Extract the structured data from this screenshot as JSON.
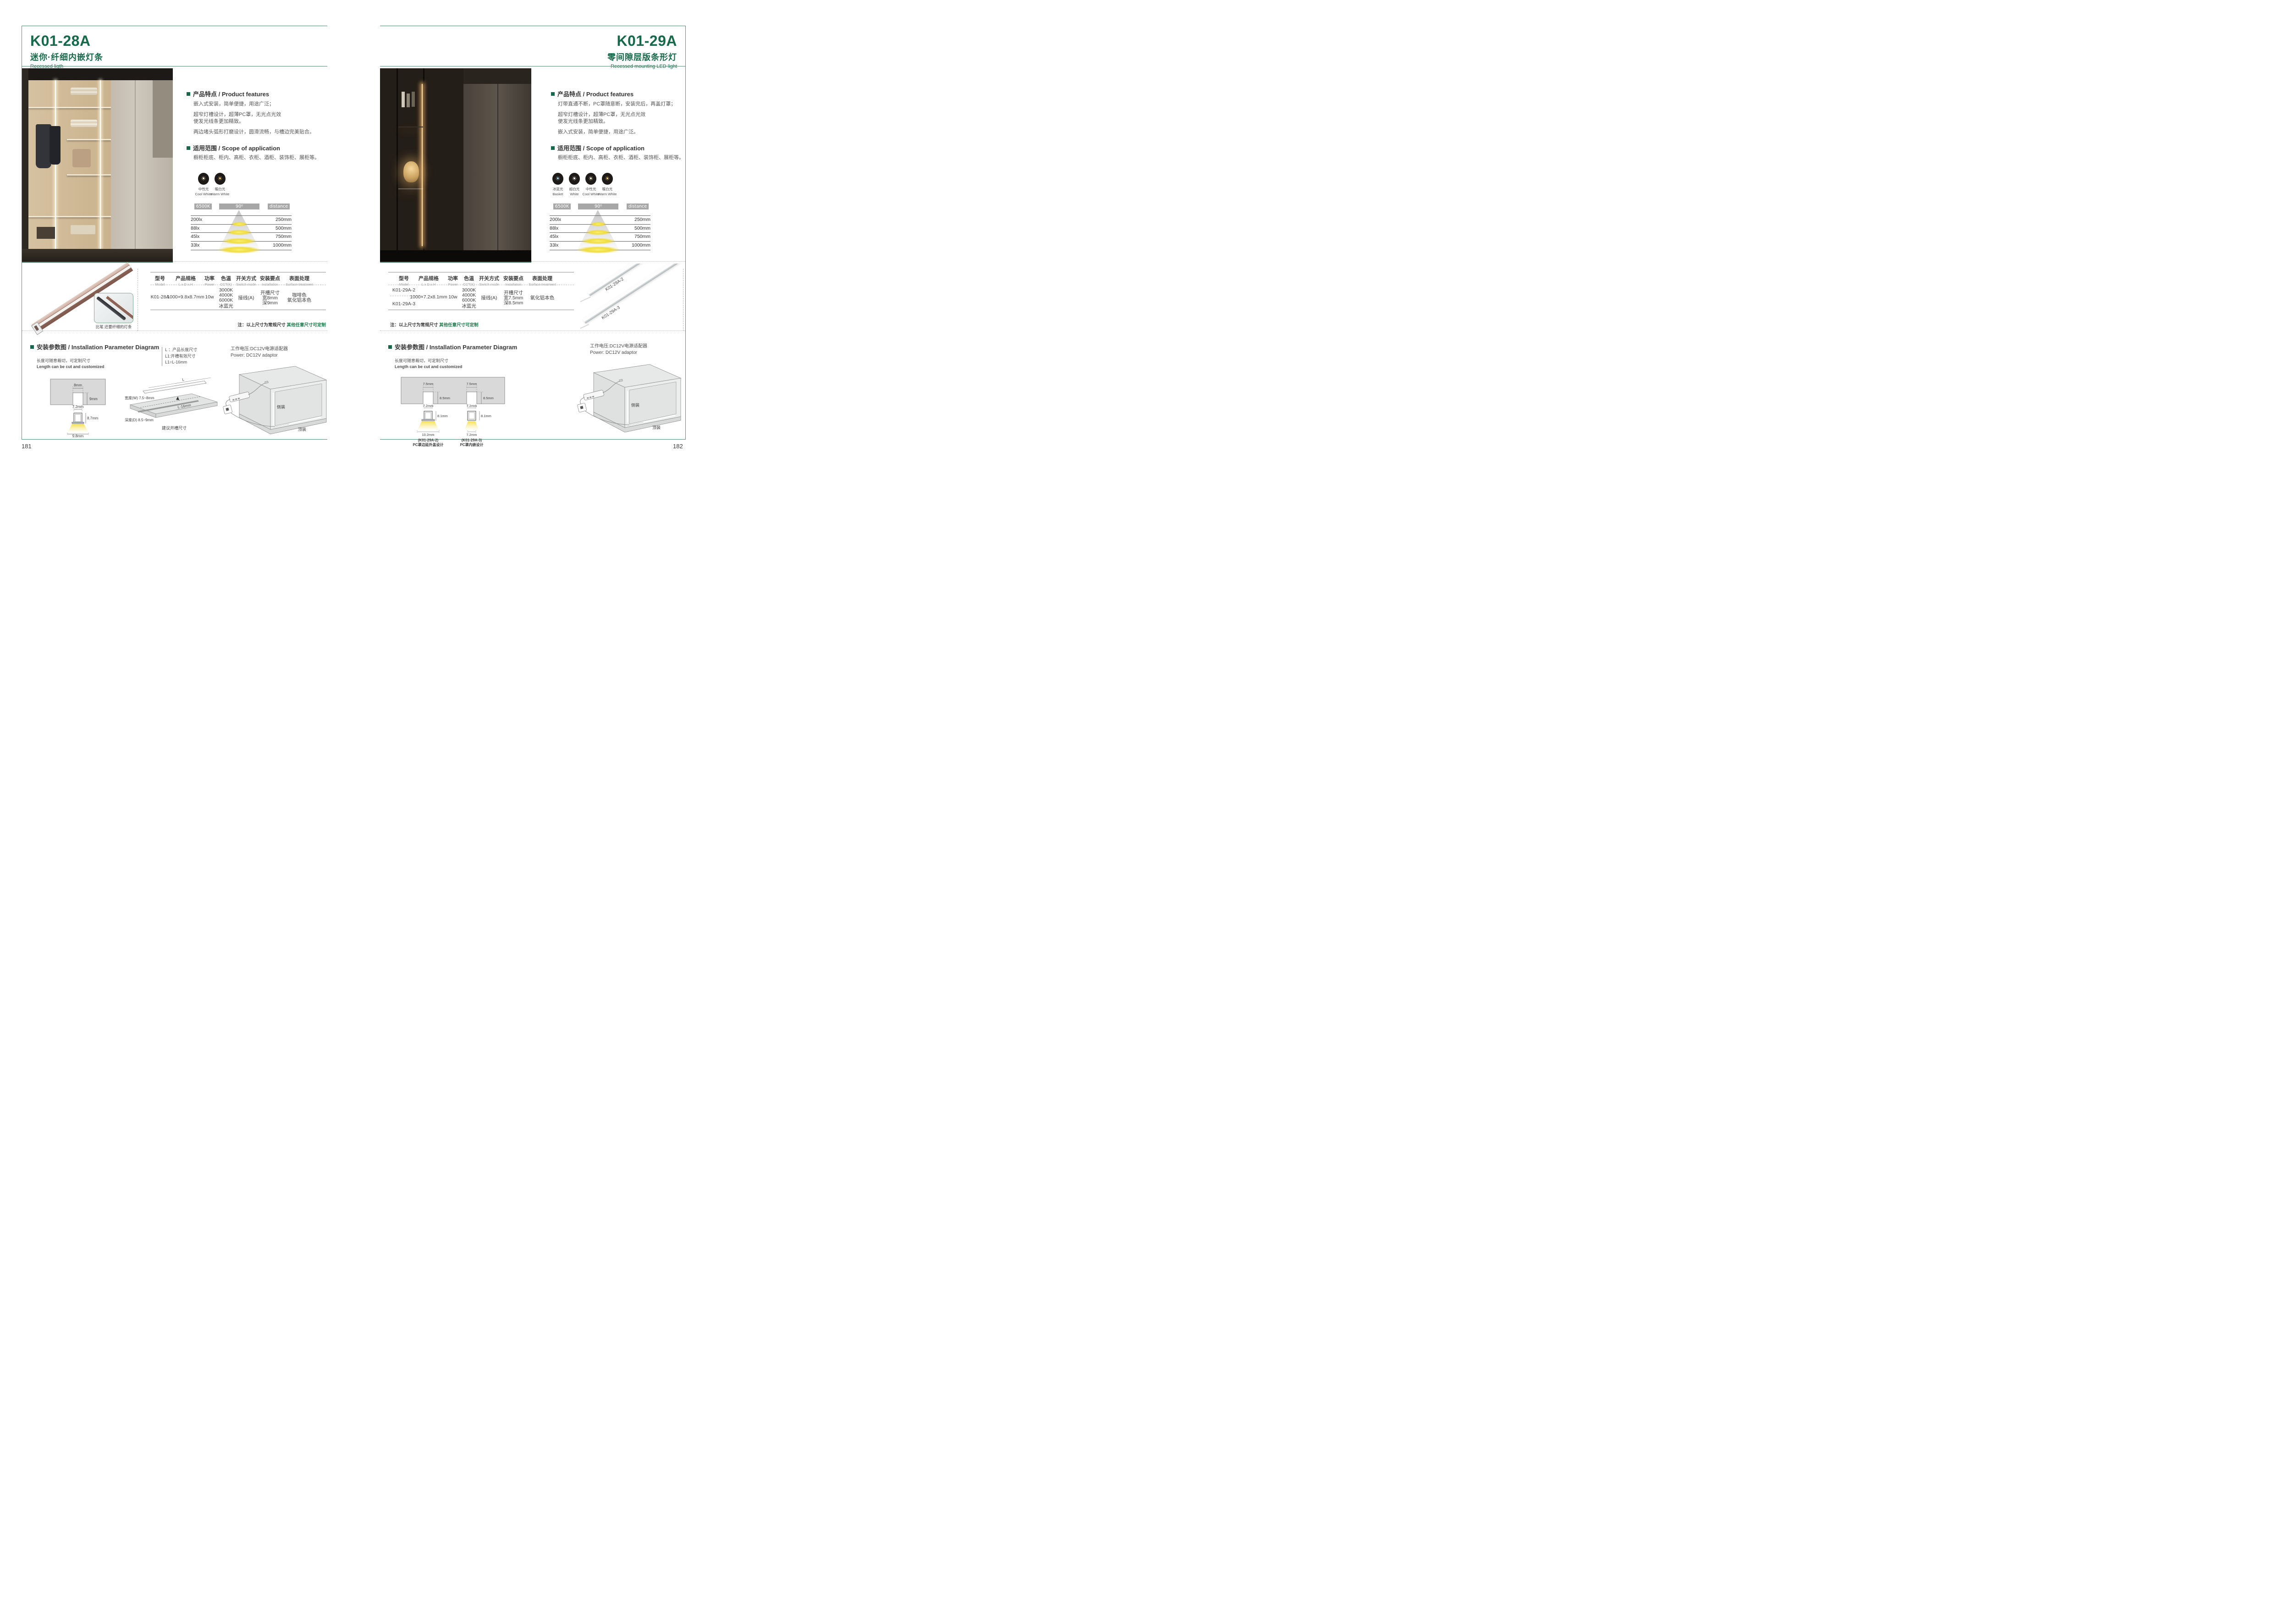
{
  "accent": {
    "green": "#16694a",
    "frame": "#5d8973",
    "note_green": "#1e7a4d"
  },
  "chart_data": [
    {
      "type": "table",
      "cct": "6500K",
      "beam_angle": "90⁰",
      "distance_label": "distance",
      "rows": [
        {
          "lux": "200lx",
          "distance": "250mm"
        },
        {
          "lux": "88lx",
          "distance": "500mm"
        },
        {
          "lux": "45lx",
          "distance": "750mm"
        },
        {
          "lux": "33lx",
          "distance": "1000mm"
        }
      ]
    },
    {
      "type": "table",
      "cct": "6500K",
      "beam_angle": "90⁰",
      "distance_label": "distance",
      "rows": [
        {
          "lux": "200lx",
          "distance": "250mm"
        },
        {
          "lux": "88lx",
          "distance": "500mm"
        },
        {
          "lux": "45lx",
          "distance": "750mm"
        },
        {
          "lux": "33lx",
          "distance": "1000mm"
        }
      ]
    }
  ],
  "pages": [
    {
      "code": "K01-28A",
      "subtitle_cn": "迷你·纤细内嵌灯条",
      "subtitle_en": "Recessed ligth",
      "page_number": "181",
      "features_heading": "产品特点 / Product features",
      "features": [
        "嵌入式安装，简单便捷，用途广泛；",
        "超窄灯槽设计，超薄PC罩，无光点光效",
        "使发光线条更加精致。",
        "两边堵头弧形打磨设计，圆滑流畅，与槽边完美贴合。"
      ],
      "scope_heading": "适用范围 / Scope of application",
      "scope_text": "橱柜柜底、柜内、高柜、衣柜、酒柜、装饰柜、展柜等。",
      "light_icons": [
        {
          "label_cn": "中性光",
          "label_en": "Cool White",
          "color": "#fdf3d8"
        },
        {
          "label_cn": "暖白光",
          "label_en": "Warm White",
          "color": "#f2cc7d"
        }
      ],
      "table": {
        "headers": [
          {
            "cn": "型号",
            "en": "Model"
          },
          {
            "cn": "产品规格",
            "en": "L x D x H"
          },
          {
            "cn": "功率",
            "en": "Power"
          },
          {
            "cn": "色温",
            "en": "CCT(K)"
          },
          {
            "cn": "开关方式",
            "en": "Switch mode"
          },
          {
            "cn": "安装要点",
            "en": "Installation"
          },
          {
            "cn": "表面处理",
            "en": "Surface treatment"
          }
        ],
        "model": "K01-28A",
        "size": "1000×9.8x8.7mm",
        "power": "10w",
        "cct": [
          "3000K",
          "4000K",
          "6000K",
          "冰蓝光"
        ],
        "switch": "接线(A)",
        "install": [
          "开槽尺寸",
          "宽8mm",
          "深9mm"
        ],
        "surface": [
          "咖啡色",
          "氧化铝本色"
        ]
      },
      "note_prefix": "注：以上尺寸为常规尺寸 ",
      "note_green": "其他任意尺寸可定制",
      "photo_caption": "比笔 还要纤细的灯条",
      "install": {
        "heading": "安装参数图 / Installation Parameter Diagram",
        "length_cn": "长度可随意裁切，可定制尺寸",
        "length_en": "Length can be cut and customized",
        "cross": {
          "slot_w": "8mm",
          "slot_d": "9mm",
          "prof_w": "7.2mm",
          "prof_h": "8.7mm",
          "beam_w": "9.8mm"
        },
        "legend": [
          "L ：产品长度尺寸",
          "L1:开槽有效尺寸",
          "L1=L-16mm"
        ],
        "board": {
          "len": "L",
          "len2": "L-16mm",
          "width": "宽度(W) 7.5~8mm",
          "depth": "深度(D) 8.5~9mm",
          "suggest": "建议开槽尺寸"
        },
        "power_cn": "工作电压:DC12V电源适配器",
        "power_en": "Power: DC12V adaptor",
        "mount_side": "侧装",
        "mount_top": "顶装"
      }
    },
    {
      "code": "K01-29A",
      "subtitle_cn": "零间隙层版条形灯",
      "subtitle_en": "Recessed mounting LED light",
      "page_number": "182",
      "features_heading": "产品特点 / Product features",
      "features": [
        "灯带直通不断，PC罩随意断，安装完后，再盖灯罩；",
        "超窄灯槽设计，超薄PC罩，无光点光效",
        "使发光线条更加精致。",
        "嵌入式安装，简单便捷，用途广泛。"
      ],
      "scope_heading": "适用范围 / Scope of application",
      "scope_text": "橱柜柜底、柜内、高柜、衣柜、酒柜、装饰柜、展柜等。",
      "light_icons": [
        {
          "label_cn": "冰蓝光",
          "label_en": "Basket",
          "color": "#a9d9f2"
        },
        {
          "label_cn": "超白光",
          "label_en": "White",
          "color": "#ffffff"
        },
        {
          "label_cn": "中性光",
          "label_en": "Cool White",
          "color": "#fdf3d8"
        },
        {
          "label_cn": "暖白光",
          "label_en": "Warm White",
          "color": "#f2cc7d"
        }
      ],
      "table": {
        "headers": [
          {
            "cn": "型号",
            "en": "Model"
          },
          {
            "cn": "产品规格",
            "en": "L x D x H"
          },
          {
            "cn": "功率",
            "en": "Power"
          },
          {
            "cn": "色温",
            "en": "CCT(K)"
          },
          {
            "cn": "开关方式",
            "en": "Switch mode"
          },
          {
            "cn": "安装要点",
            "en": "Installation"
          },
          {
            "cn": "表面处理",
            "en": "Surface treatment"
          }
        ],
        "models": [
          "K01-29A-2",
          "K01-29A-3"
        ],
        "size": "1000×7.2x8.1mm",
        "power": "10w",
        "cct": [
          "3000K",
          "4000K",
          "6000K",
          "冰蓝光"
        ],
        "switch": "接线(A)",
        "install": [
          "开槽尺寸",
          "宽7.5mm",
          "深8.5mm"
        ],
        "surface": [
          "氧化铝本色"
        ]
      },
      "note_prefix": "注：以上尺寸为常规尺寸 ",
      "note_green": "其他任意尺寸可定制",
      "strip_labels": [
        "K01-29A-2",
        "K01-29A-3"
      ],
      "install": {
        "heading": "安装参数图 / Installation Parameter Diagram",
        "length_cn": "长度可随意裁切，可定制尺寸",
        "length_en": "Length can be cut and customized",
        "sections": [
          {
            "model": "(K01-29A-2)",
            "desc": "PC罩边延外盖设计",
            "slot_w": "7.5mm",
            "slot_d": "8.5mm",
            "prof_w": "7.2mm",
            "prof_h": "8.1mm",
            "beam_w": "10.2mm"
          },
          {
            "model": "(K01-29A-3)",
            "desc": "PC罩内嵌设计",
            "slot_w": "7.5mm",
            "slot_d": "8.5mm",
            "prof_w": "7.2mm",
            "prof_h": "8.1mm",
            "beam_w": "7.2mm"
          }
        ],
        "power_cn": "工作电压:DC12V电源适配器",
        "power_en": "Power: DC12V adaptor",
        "mount_side": "侧装",
        "mount_top": "顶装"
      }
    }
  ]
}
